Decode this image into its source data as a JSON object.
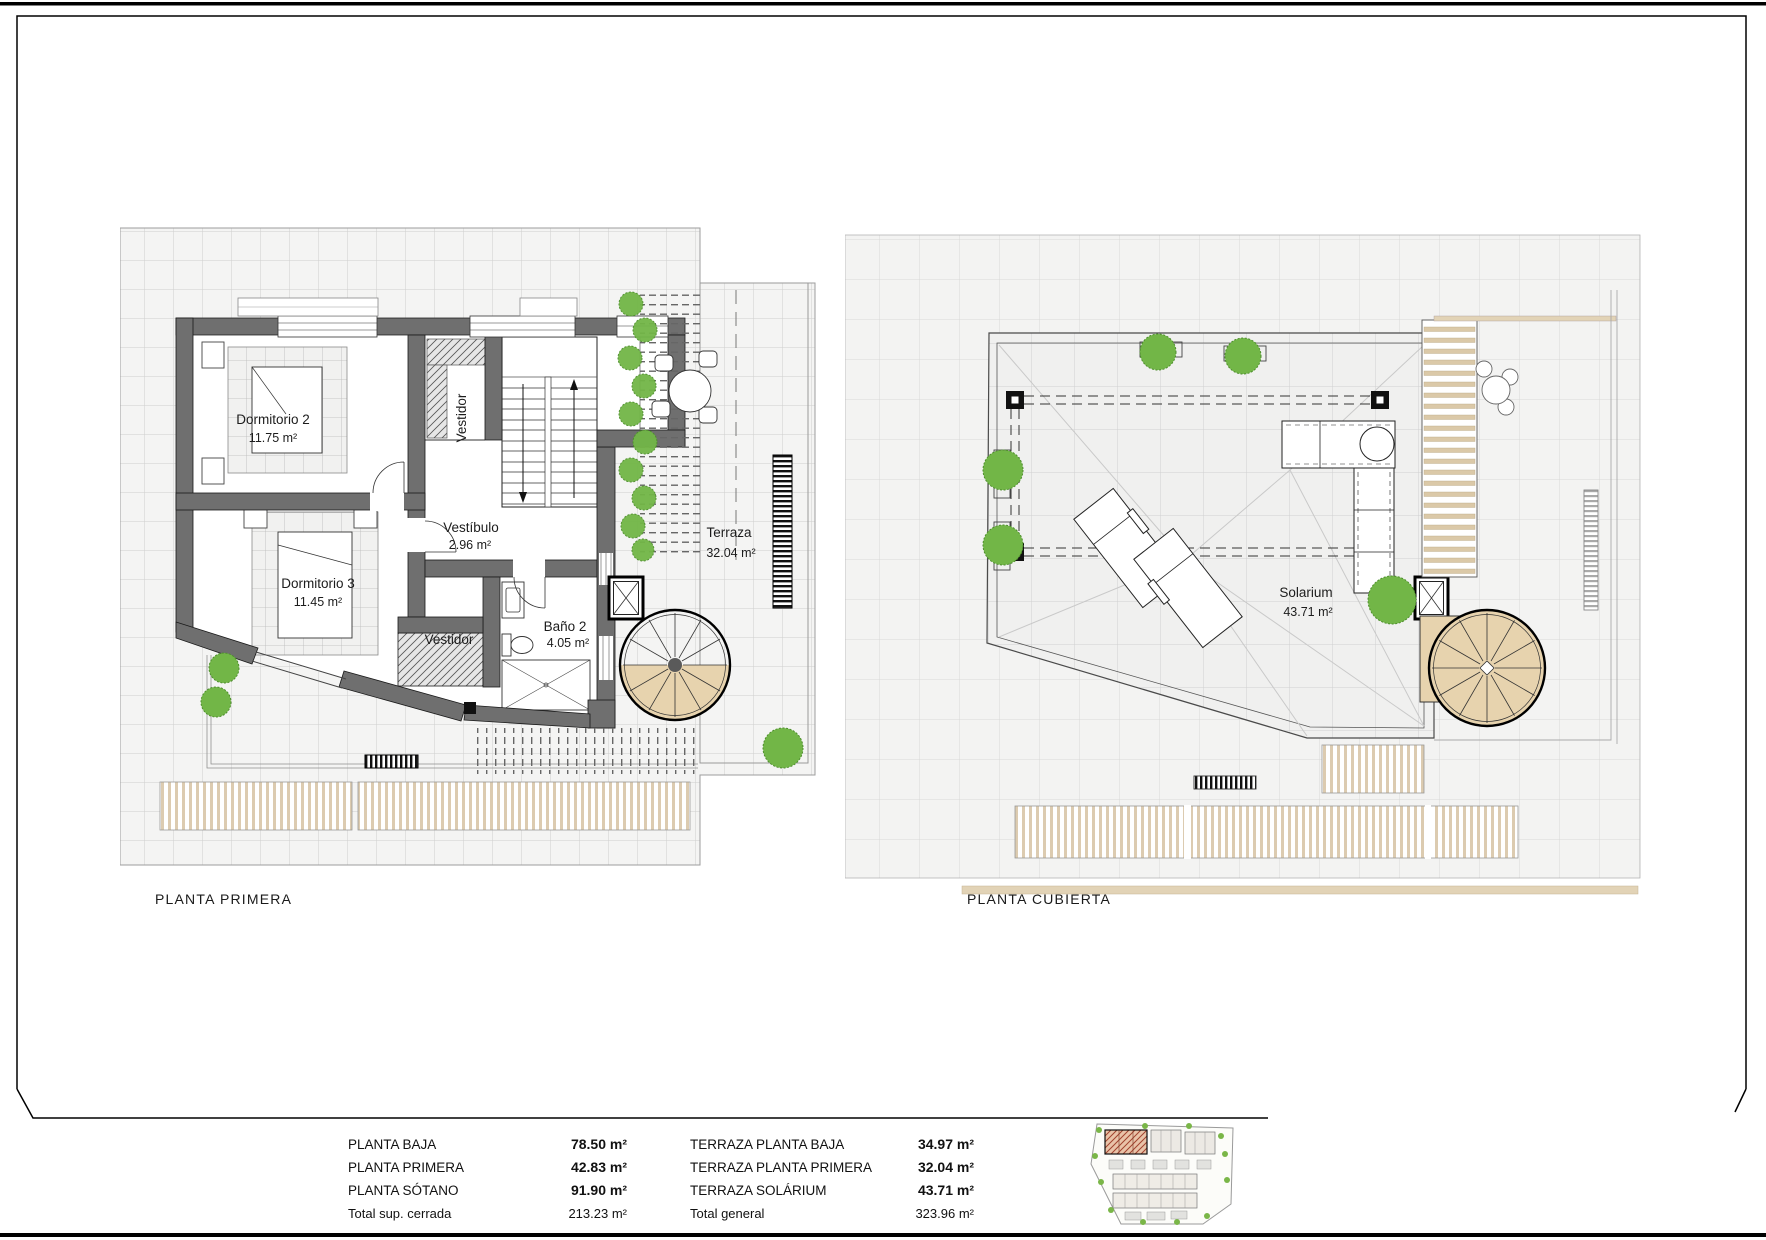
{
  "plans": {
    "left": {
      "title": "PLANTA PRIMERA",
      "rooms": {
        "dorm2": {
          "name": "Dormitorio 2",
          "area": "11.75 m²"
        },
        "dorm3": {
          "name": "Dormitorio 3",
          "area": "11.45 m²"
        },
        "vestidor_top": {
          "name": "Vestidor"
        },
        "vestibulo": {
          "name": "Vestíbulo",
          "area": "2.96 m²"
        },
        "vestidor_bottom": {
          "name": "Vestidor"
        },
        "bano2": {
          "name": "Baño 2",
          "area": "4.05 m²"
        },
        "terraza": {
          "name": "Terraza",
          "area": "32.04 m²"
        }
      }
    },
    "right": {
      "title": "PLANTA CUBIERTA",
      "rooms": {
        "solarium": {
          "name": "Solarium",
          "area": "43.71 m²"
        }
      }
    }
  },
  "summary": {
    "left": [
      {
        "label": "PLANTA BAJA",
        "value": "78.50 m²"
      },
      {
        "label": "PLANTA PRIMERA",
        "value": "42.83 m²"
      },
      {
        "label": "PLANTA SÓTANO",
        "value": "91.90 m²"
      },
      {
        "label": "Total sup. cerrada",
        "value": "213.23 m²"
      }
    ],
    "right": [
      {
        "label": "TERRAZA PLANTA BAJA",
        "value": "34.97 m²"
      },
      {
        "label": "TERRAZA PLANTA PRIMERA",
        "value": "32.04 m²"
      },
      {
        "label": "TERRAZA SOLÁRIUM",
        "value": "43.71 m²"
      },
      {
        "label": "Total general",
        "value": "323.96 m²"
      }
    ]
  },
  "colors": {
    "wall": "#6f6f6f",
    "wood": "#e7d3ae",
    "deck_stripe": "#dccbb0",
    "plant": "#72b647",
    "site_highlight": "#b5553a"
  }
}
